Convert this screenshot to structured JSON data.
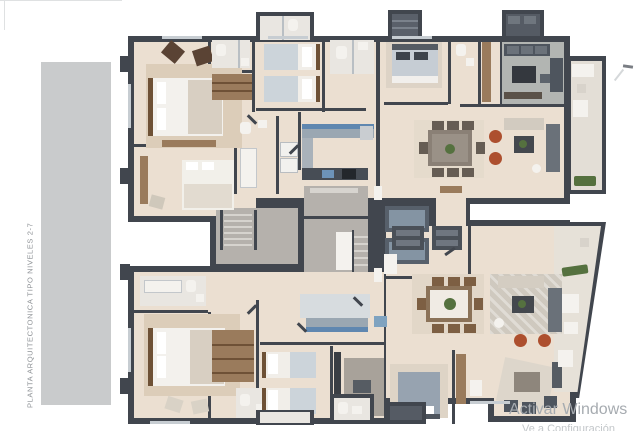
{
  "sidebar": {
    "title": "PLANTA ARQUITECTONICA TIPO NIVELES 2-7",
    "bar_color": "#c9cbcc"
  },
  "watermark": {
    "line1": "Activar Windows",
    "line2": "Ve a Configuración para activar Windows."
  },
  "floor_plan": {
    "type": "residential-apartment-typical-level-plan",
    "rooms": [
      "master-bedroom",
      "guest-bedroom",
      "twin-bedroom",
      "bathroom",
      "walk-in-closet",
      "laundry",
      "kitchen",
      "dining-room",
      "living-room",
      "den",
      "foyer",
      "corridor",
      "main-stairs",
      "service-stairs",
      "elevators",
      "elevator-lobby",
      "balcony"
    ],
    "palette": {
      "background": "#ffffff",
      "walls": "#41464e",
      "floor": "#ebdfd1",
      "core_concrete": "#b5b1ac",
      "wood": "#9a7b5c",
      "upholstery_gray": "#4e555e",
      "bedding_blue_gray": "#c6cdd4",
      "terracotta_accent": "#ad4f2e",
      "plant_green": "#55713f",
      "kitchen_blue_tile": "#5f87b0"
    }
  }
}
